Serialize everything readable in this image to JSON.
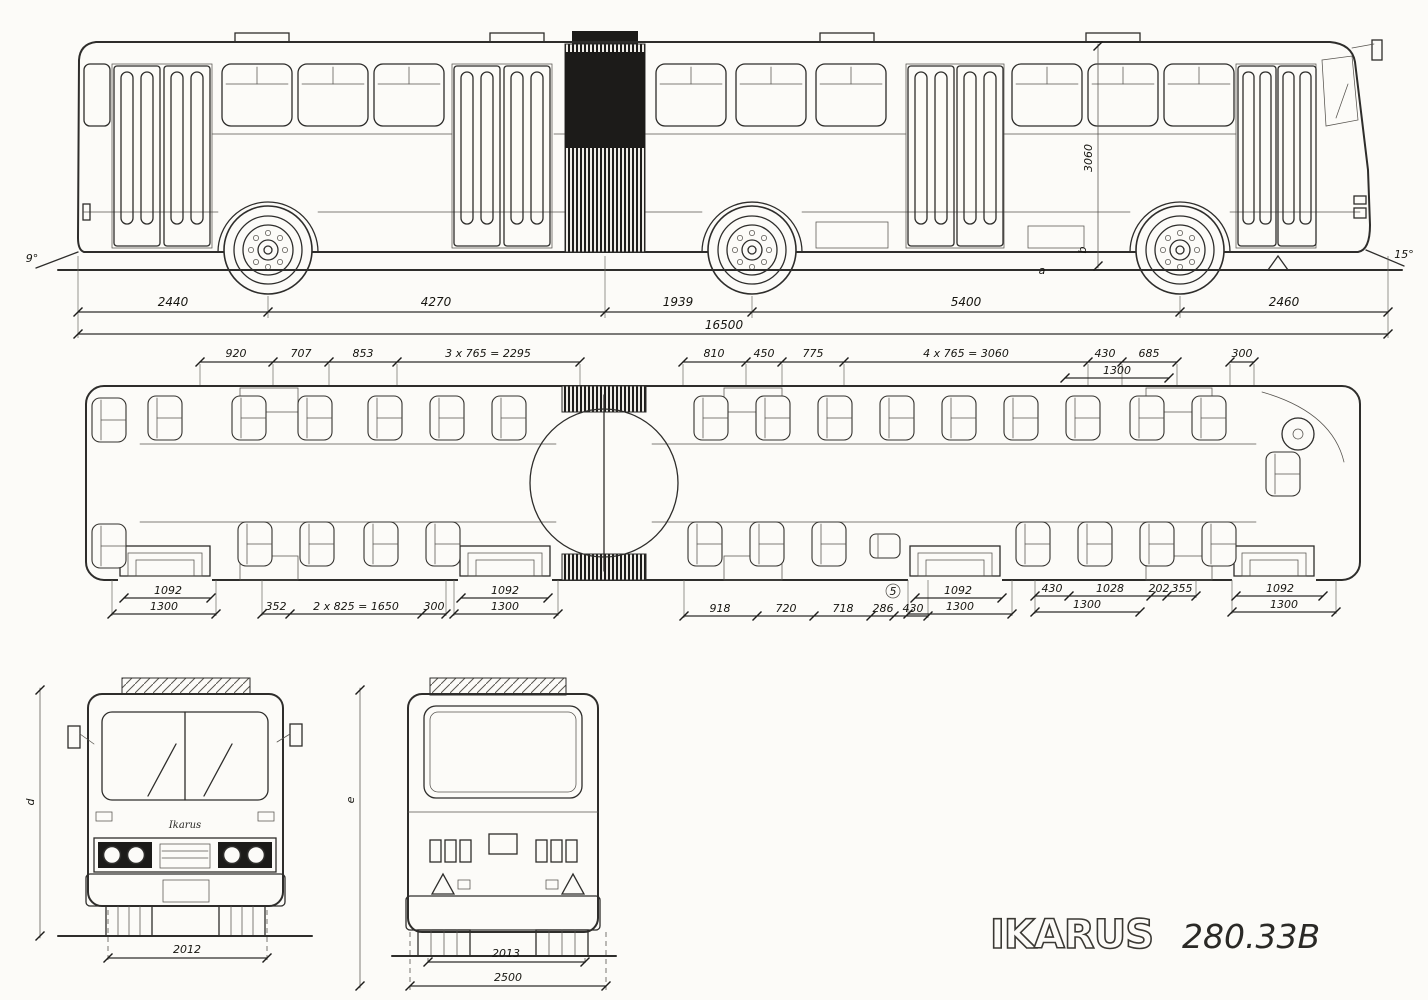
{
  "brand": {
    "logo": "IKARUS",
    "model": "280.33B"
  },
  "side_view": {
    "segments": {
      "s0": "2440",
      "s1": "4270",
      "s2": "1939",
      "s3": "5400",
      "s4": "2460"
    },
    "total": "16500",
    "height": "3060",
    "angle_left": "9°",
    "angle_right": "15°",
    "marker_a": "a",
    "marker_b": "b"
  },
  "plan_view": {
    "top": {
      "d0": "920",
      "d1": "707",
      "d2": "853",
      "d3": "3 x 765 = 2295",
      "d4": "810",
      "d5": "450",
      "d6": "775",
      "d7": "4 x 765 = 3060",
      "d8": "430",
      "d9": "685",
      "d10": "1300",
      "d11": "300"
    },
    "bottom": {
      "door1_w": "1092",
      "door1_t": "1300",
      "b0": "352",
      "b1": "2 x 825 = 1650",
      "b2": "300",
      "door2_w": "1092",
      "door2_t": "1300",
      "m0": "918",
      "m1": "720",
      "m2": "718",
      "m3": "286",
      "m4": "430",
      "ref": "5",
      "door3_w": "1092",
      "door3_t": "1300",
      "r0": "430",
      "r1": "1028",
      "r2": "202",
      "r3": "355",
      "r4": "1300",
      "door4_w": "1092",
      "door4_t": "1300"
    }
  },
  "front_view": {
    "badge": "Ikarus",
    "track": "2012",
    "marker": "d"
  },
  "rear_view": {
    "track": "2013",
    "width": "2500",
    "marker": "e"
  }
}
